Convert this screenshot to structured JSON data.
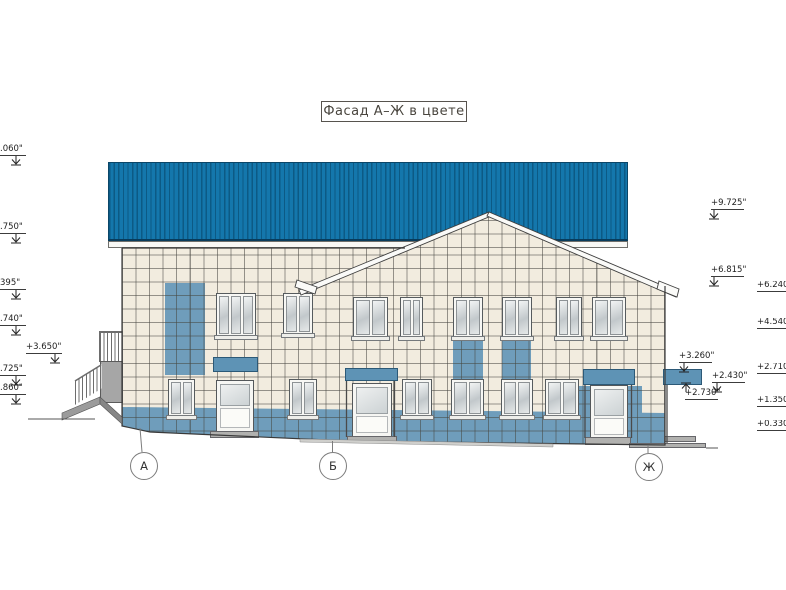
{
  "title": "Фасад А–Ж в цвете",
  "marks": {
    "left": [
      ".060\"",
      ".750\"",
      "395\"",
      ".740\"",
      "+3.650\"",
      ".725\"",
      ".860\""
    ],
    "right": [
      "+9.725\"",
      "+6.815\"",
      "+6.240\"",
      "+4.540\"",
      "+3.260\"",
      "+2.430\"",
      "+2.710\"",
      "+2.730\"",
      "+1.350\"",
      "+0.330\""
    ]
  },
  "axes": [
    "А",
    "Б",
    "Ж"
  ],
  "colors": {
    "roof_blue": "#1374a8",
    "tile_blue": "#6f9dbb",
    "canopy_blue": "#5e93b5",
    "wall_cream": "#f2ecdf"
  }
}
